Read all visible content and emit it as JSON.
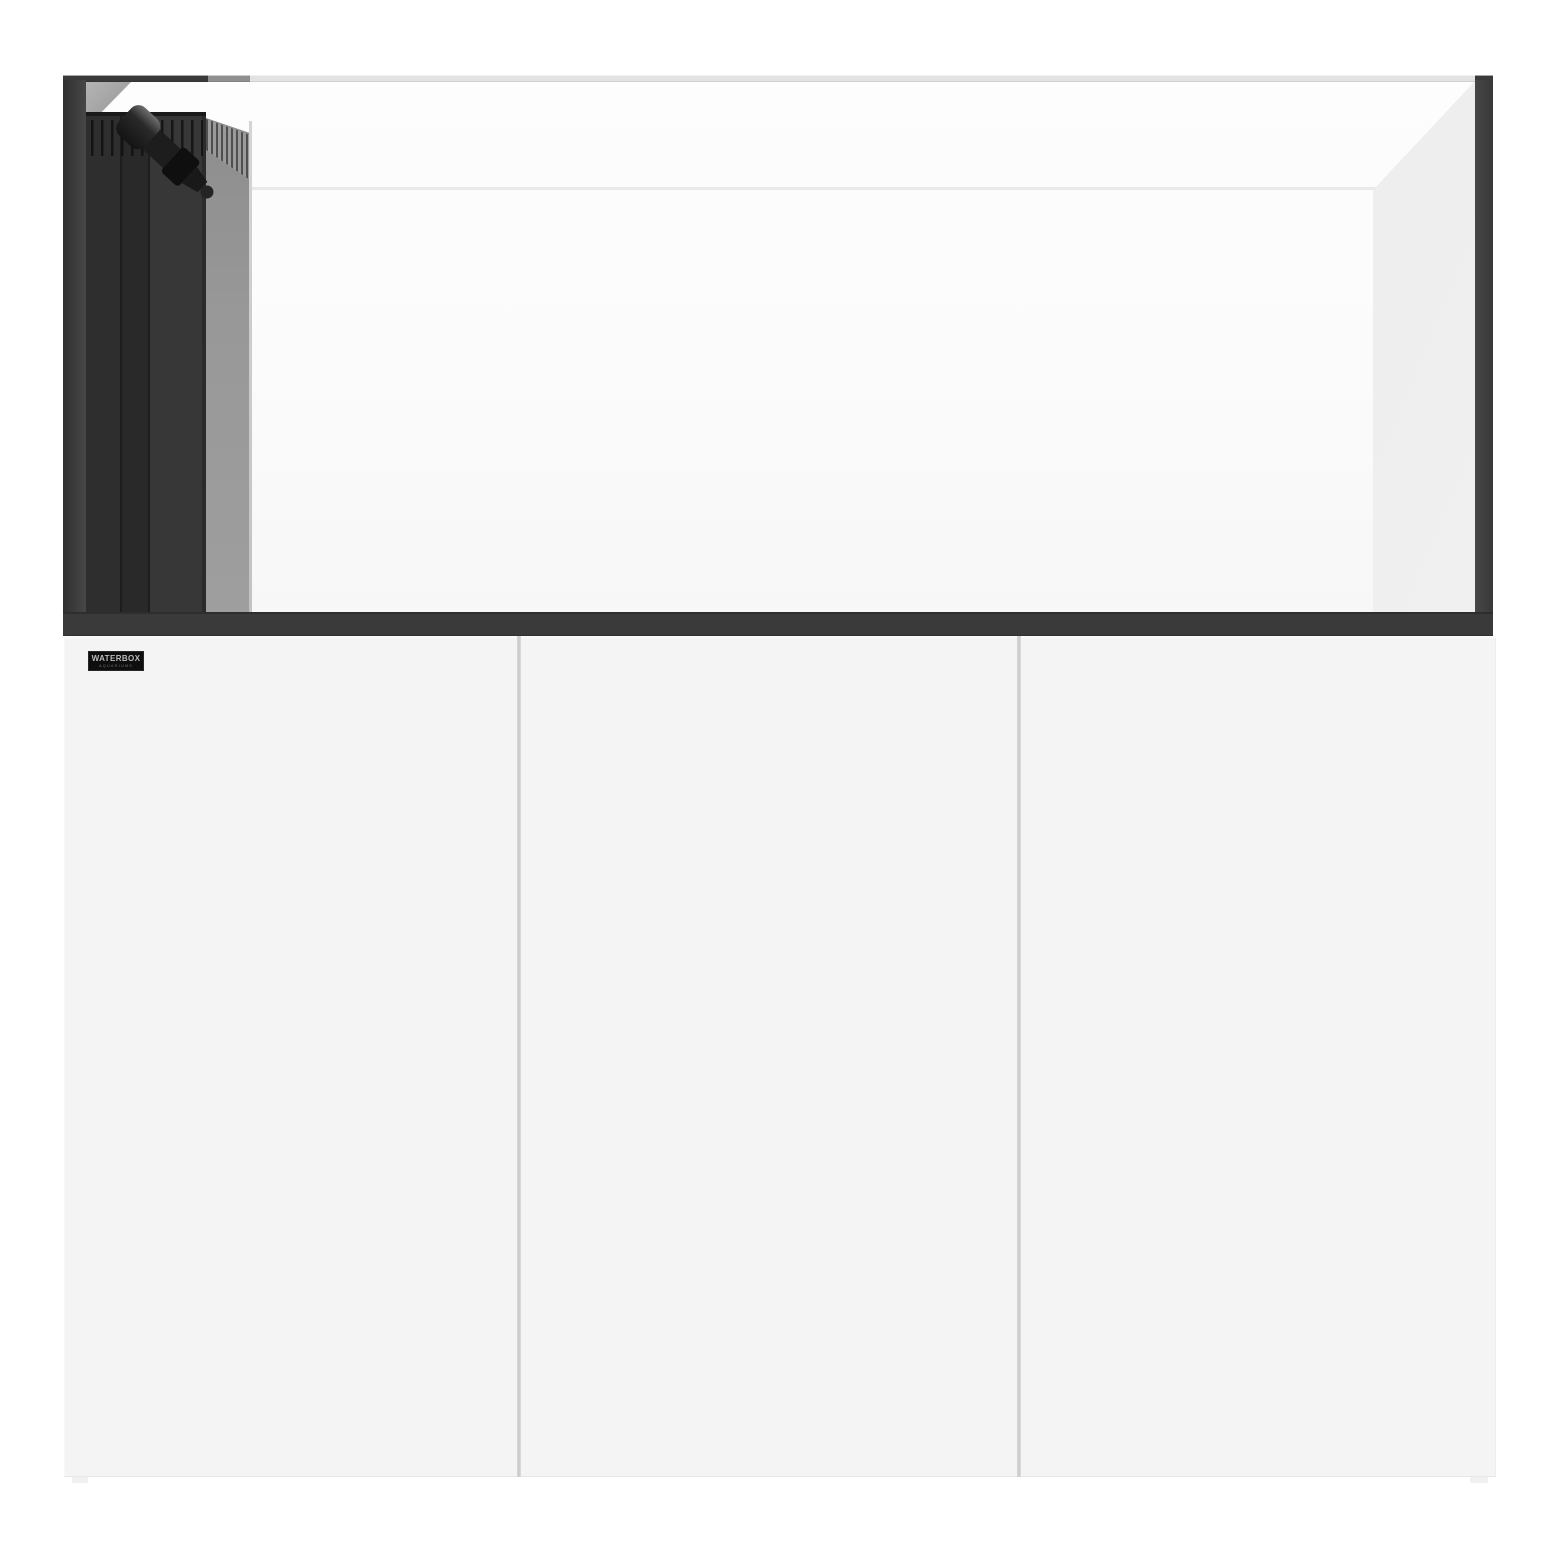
{
  "image": {
    "description": "Product render of a rimless aquarium with black trim and left-side overflow box with return plumbing, on a white three-door cabinet stand",
    "background": "white"
  },
  "brand_badge": {
    "line1": "WATERBOX",
    "line2": "AQUARIUMS"
  },
  "cabinet": {
    "door_count": 3
  },
  "colors": {
    "page-bg": "#ffffff",
    "trim-dark": "#3a3a3a",
    "glass-line": "#e9e9e9",
    "overflow-front": "#2e2e2e",
    "overflow-side": "#9e9e9e",
    "slot-color": "#101010",
    "pipe-color": "#141414",
    "cabinet-color": "#f4f4f5",
    "seam-color": "#c9c9c9",
    "badge-bg": "#0e0e0e",
    "badge-text": "#bdbdbd"
  }
}
